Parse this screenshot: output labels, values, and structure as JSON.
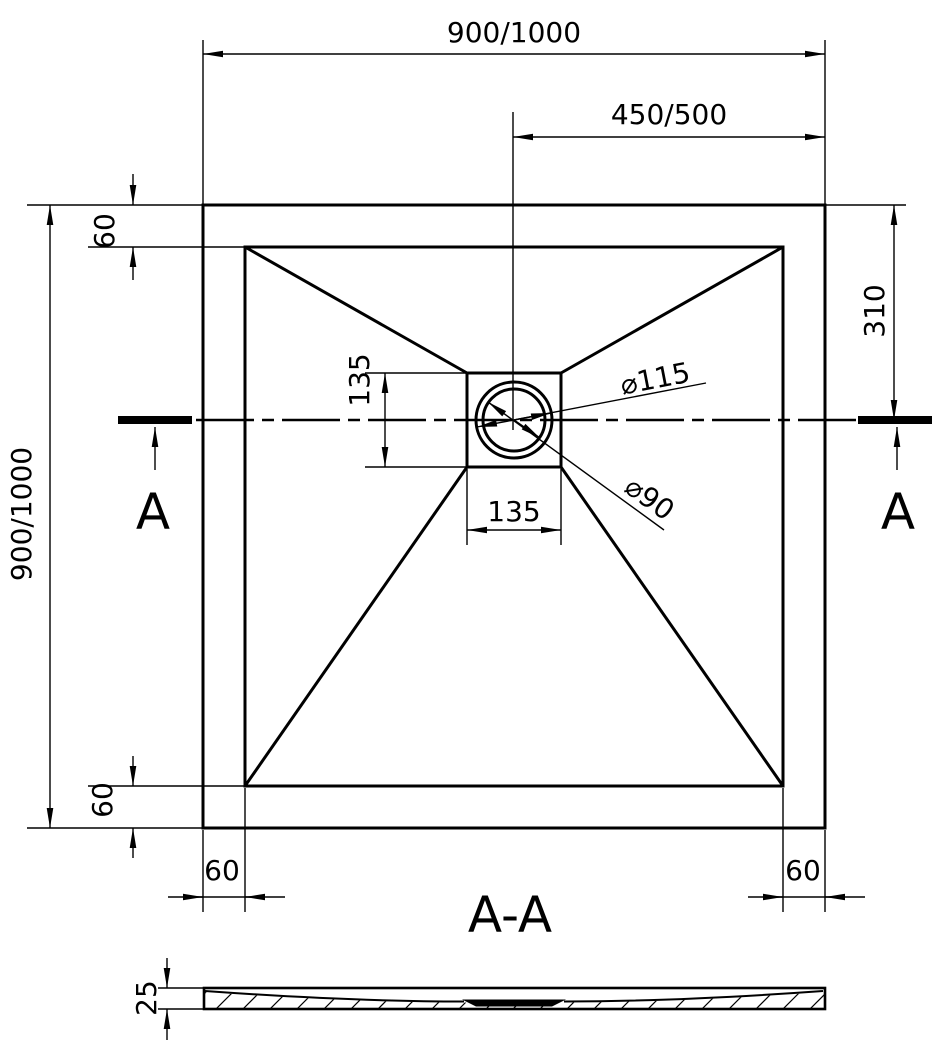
{
  "plan_view": {
    "dim_overall_width": "900/1000",
    "dim_center_to_right_edge": "450/500",
    "dim_overall_height": "900/1000",
    "dim_rim_top": "60",
    "dim_rim_bottom": "60",
    "dim_rim_left": "60",
    "dim_rim_right": "60",
    "dim_top_edge_to_drain_center": "310",
    "dim_drain_square_height": "135",
    "dim_drain_square_width": "135",
    "dim_drain_flange_diameter": "⌀115",
    "dim_drain_hole_diameter": "⌀90",
    "section_marker_left": "A",
    "section_marker_right": "A"
  },
  "section_view": {
    "title": "A-A",
    "dim_thickness": "25"
  },
  "colors": {
    "line": "#000000",
    "background": "#ffffff"
  }
}
